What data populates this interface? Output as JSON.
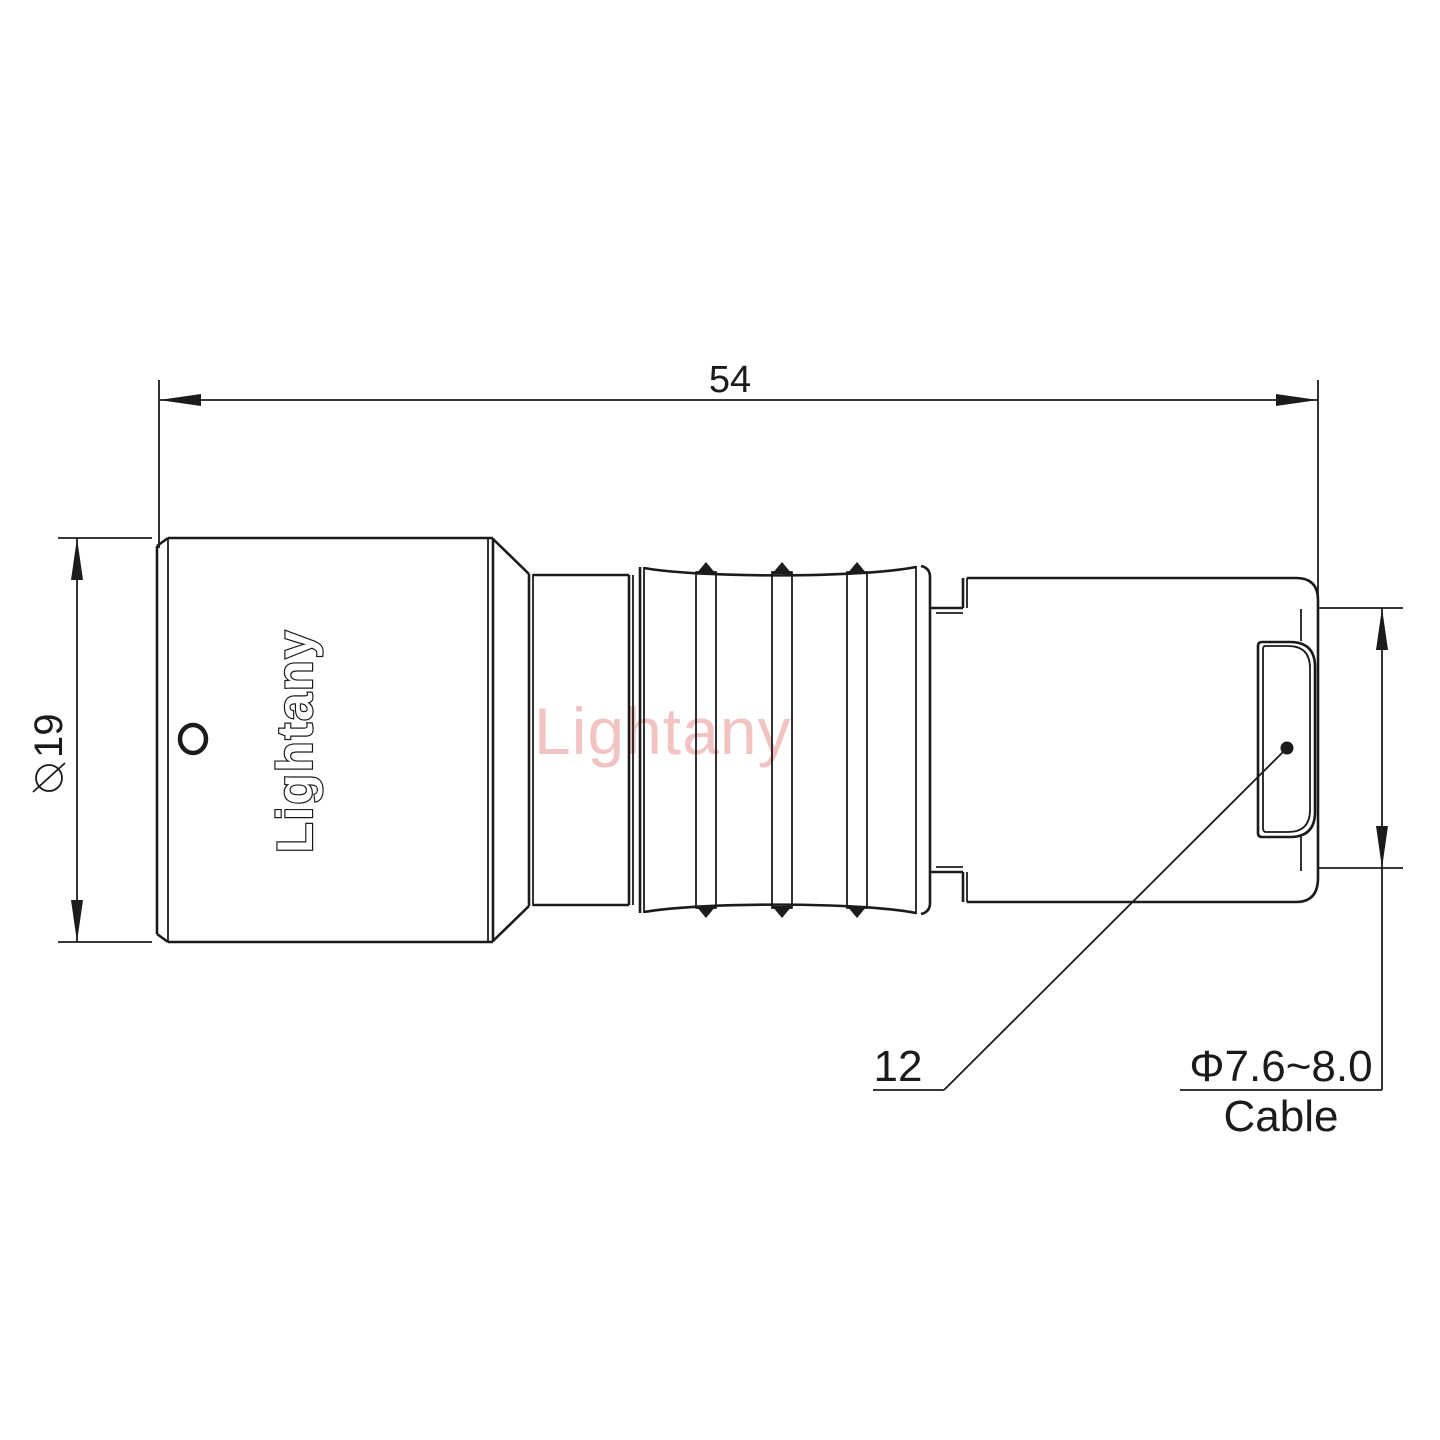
{
  "colors": {
    "ink": "#1b1b1b",
    "wm": "#f2c3c3",
    "bg": "#ffffff"
  },
  "drawing": {
    "watermark": "Lightany",
    "brand_engraving": "Lightany",
    "dimensions": {
      "length": {
        "value": "54"
      },
      "diameter": {
        "symbol": "⌀",
        "value": "19"
      },
      "bushing": {
        "value": "12"
      },
      "cable": {
        "diameter_range": "Φ7.6~8.0",
        "label": "Cable"
      }
    }
  }
}
